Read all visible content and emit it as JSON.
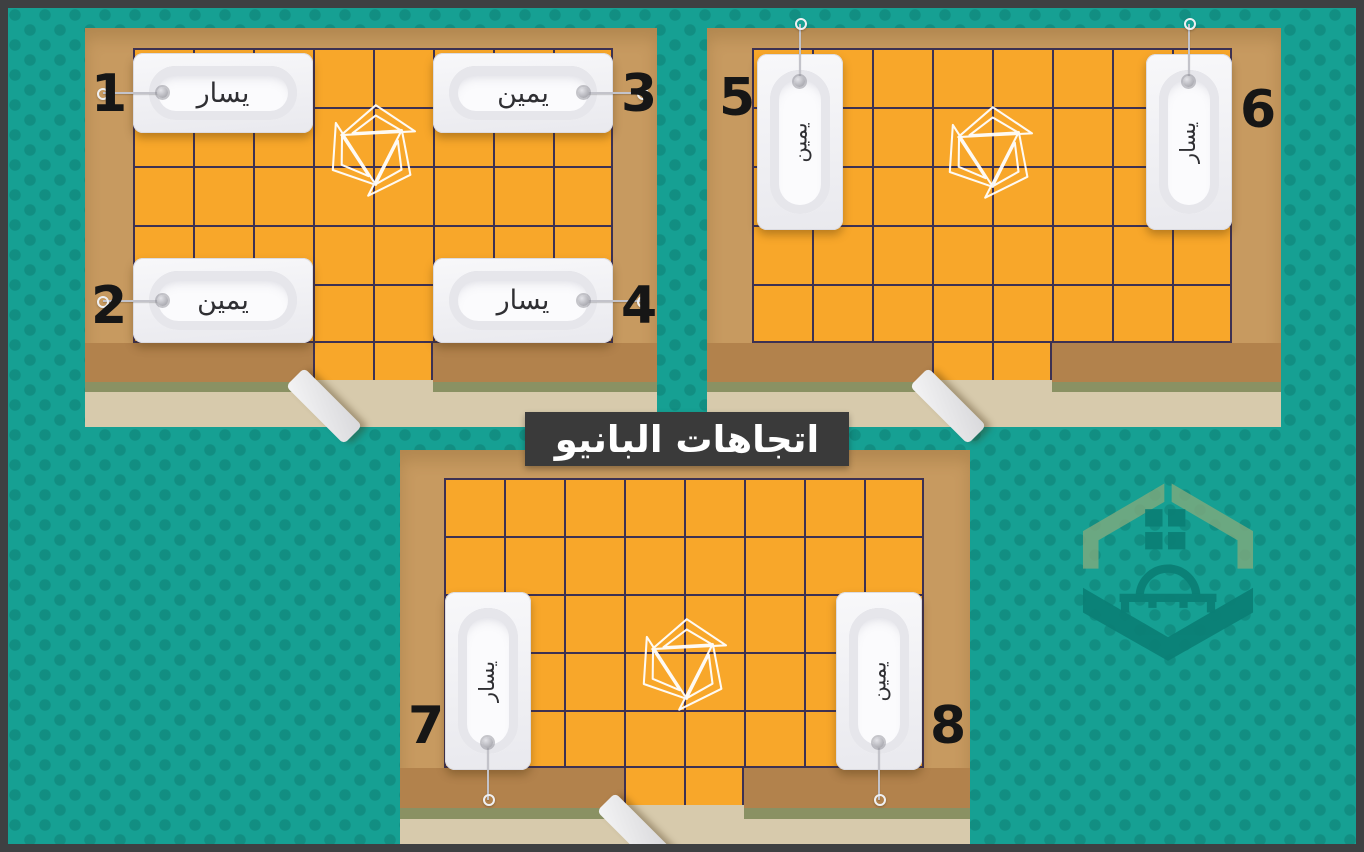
{
  "title": "اتجاهات البانيو",
  "rooms": [
    {
      "name": "room-top-left",
      "tubs": [
        {
          "number": "1",
          "label": "يسار"
        },
        {
          "number": "2",
          "label": "يمين"
        },
        {
          "number": "3",
          "label": "يمين"
        },
        {
          "number": "4",
          "label": "يسار"
        }
      ]
    },
    {
      "name": "room-top-right",
      "tubs": [
        {
          "number": "5",
          "label": "يمين"
        },
        {
          "number": "6",
          "label": "يسار"
        }
      ]
    },
    {
      "name": "room-bottom-center",
      "tubs": [
        {
          "number": "7",
          "label": "يسار"
        },
        {
          "number": "8",
          "label": "يمين"
        }
      ]
    }
  ],
  "icons": {
    "tile_center_logo": "pinwheel-triangles-icon",
    "corner_watermark": "house-home-logo-icon",
    "door": "open-door-leaf",
    "tub_tag": "drain-plug-with-cord"
  },
  "colors": {
    "background_teal": "#16a093",
    "dot_teal": "#0e8b7f",
    "wall_tan": "#c79a60",
    "wall_base_tan": "#b2824c",
    "baseboard_green": "#8a9163",
    "floor_beige": "#d7caac",
    "tile_orange": "#f8a72a",
    "grout_navy": "#3d3152",
    "tub_white": "#f4f4f6",
    "frame_gray": "#3e4042",
    "title_bg": "#3a3a3a",
    "title_text": "#ffffff",
    "number_black": "#161616",
    "watermark_green": "#84ab7d",
    "watermark_teal": "#0b7f75"
  }
}
